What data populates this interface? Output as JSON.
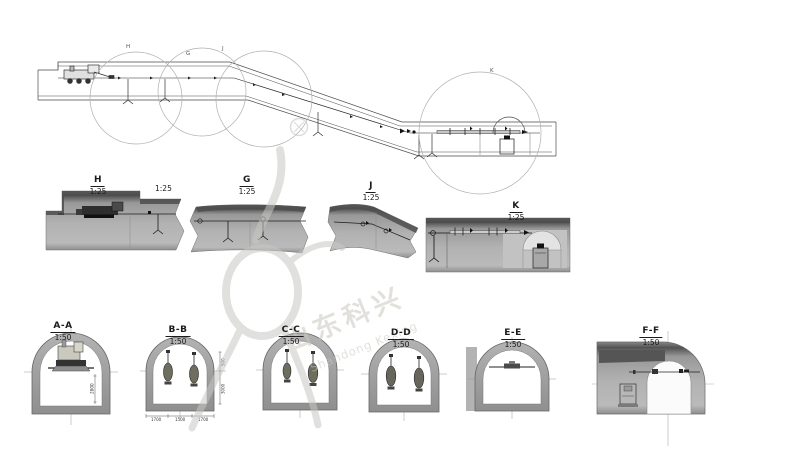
{
  "watermark": {
    "cn": "山东科兴",
    "en": "Shandong Kexing",
    "registered": "®",
    "color": "#c9c6bd"
  },
  "plan_callouts": {
    "h": "H",
    "g": "G",
    "j": "J",
    "k": "K"
  },
  "details": {
    "h": {
      "label": "H",
      "scale": "1:25"
    },
    "h_extra_scale": "1:25",
    "g": {
      "label": "G",
      "scale": "1:25"
    },
    "j": {
      "label": "J",
      "scale": "1:25"
    },
    "k": {
      "label": "K",
      "scale": "1:25"
    }
  },
  "sections": {
    "aa": {
      "label": "A-A",
      "scale": "1:50"
    },
    "bb": {
      "label": "B-B",
      "scale": "1:50"
    },
    "cc": {
      "label": "C-C",
      "scale": "1:50"
    },
    "dd": {
      "label": "D-D",
      "scale": "1:50"
    },
    "ee": {
      "label": "E-E",
      "scale": "1:50"
    },
    "ff": {
      "label": "F-F",
      "scale": "1:50"
    }
  },
  "dimensions": {
    "aa_height": "2800",
    "bb_right_upper": "500",
    "bb_right_lower": "3000",
    "bb_bottom_left": "1700",
    "bb_bottom_mid": "1500",
    "bb_bottom_right": "1700"
  },
  "colors": {
    "line": "#4a4a4a",
    "section_gray": "#b0b0b0",
    "section_dark_band": "#4e4e4e",
    "ring_gray": "#a2a2a2",
    "watermark_gray": "#c7c7c4"
  }
}
